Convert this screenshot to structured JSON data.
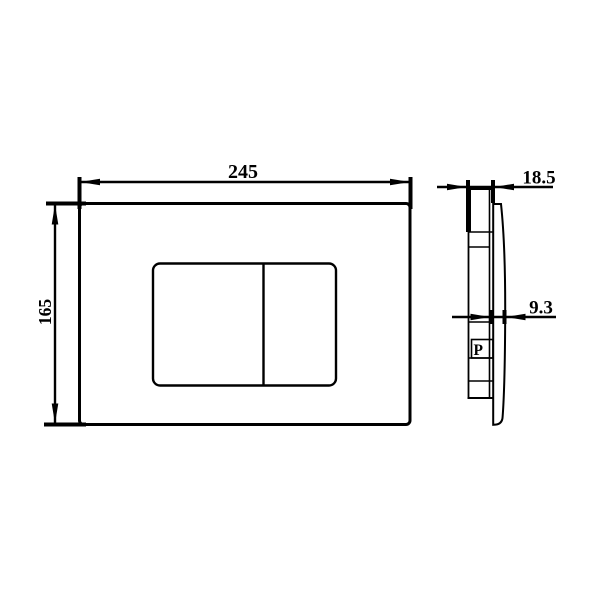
{
  "drawing": {
    "bg_color": "#ffffff",
    "line_color": "#000000",
    "labels": {
      "front_width": "245",
      "front_height": "165",
      "side_total_depth": "18.5",
      "side_plate_depth": "9.3",
      "side_port": "P"
    }
  }
}
